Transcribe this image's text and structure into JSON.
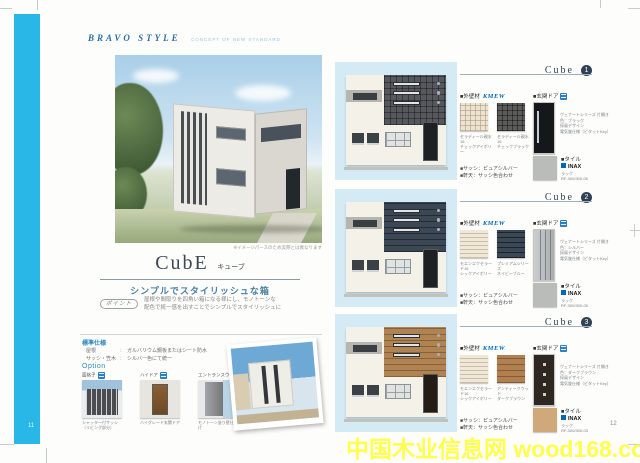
{
  "page": {
    "brand": "BRAVO STYLE",
    "brand_tagline": "CONCEPT OF NEW STANDARD",
    "page_number_left": "11",
    "page_number_right": "12",
    "watermark": "中国木业信息网 wood168.com"
  },
  "colors": {
    "accent_cyan": "#29b7e8",
    "brand_blue": "#2b6ea6",
    "subtitle_blue": "#4b7fa0",
    "panel_blue": "#d4eaf5",
    "kmew_blue": "#0068b7",
    "section_navy": "#2f4254",
    "watermark_yellow": "#ffff4d",
    "cube1_accent": "#55585c",
    "cube2_accent": "#3b4754",
    "cube3_accent": "#b08353"
  },
  "left_page": {
    "render_caption": "※イメージパースのため実際とは異なります",
    "title": "CubE",
    "title_kana": "キューブ",
    "subtitle": "シンプルでスタイリッシュな箱",
    "point": {
      "label": "ポイント",
      "line1": "屋根や間取りを四角い箱になる様にし、モノトーンな",
      "line2": "配色で統一感を出すことでシンプルでスタイリッシュに"
    },
    "spec": {
      "heading": "標準仕様",
      "rows": [
        {
          "label": "屋根",
          "value": "ガルバリウム鋼板またはシート防水"
        },
        {
          "label": "サッシ・笠木",
          "value": "シルバー色にて統一"
        }
      ]
    },
    "options": {
      "heading": "Option",
      "items": [
        {
          "label": "面格子",
          "caption": "シャッター付サッシ（リビング部分）"
        },
        {
          "label": "ハイドア",
          "caption": "ハイグレード玄関ドア"
        },
        {
          "label": "エントランスウォール",
          "caption": "モノトーン塗り壁仕上げ"
        }
      ]
    }
  },
  "sections": [
    {
      "title": "Cube",
      "number": "1",
      "wall_heading": "■外壁材",
      "wall_brand": "KMEW",
      "swatches": [
        {
          "caption1": "セラディール親水16",
          "caption2": "チェックアイボリー"
        },
        {
          "caption1": "セラディール親水16",
          "caption2": "チェックブラック"
        }
      ],
      "door_heading": "■玄関ドア",
      "door_caption": [
        "ヴェナートシリーズ 片開き",
        "色：ブラック",
        "採風デザイン",
        "電気錠仕様（ピタットKey）"
      ],
      "tile_heading": "■タイル",
      "tile_brand": "INAX",
      "tile_caption": [
        "ラック",
        "RF-300/300-05"
      ],
      "notes": [
        "■サッシ：ピュアシルバー",
        "■軒天：サッシ色合わせ"
      ]
    },
    {
      "title": "Cube",
      "number": "2",
      "wall_heading": "■外壁材",
      "wall_brand": "KMEW",
      "swatches": [
        {
          "caption1": "モエンエクセラード16",
          "caption2": "シックアイボリー"
        },
        {
          "caption1": "プレミアムシリーズ",
          "caption2": "ネイビーブルー"
        }
      ],
      "door_heading": "■玄関ドア",
      "door_caption": [
        "ヴェナートシリーズ 片開き",
        "色：シルバー",
        "採風デザイン",
        "電気錠仕様（ピタットKey）"
      ],
      "tile_heading": "■タイル",
      "tile_brand": "INAX",
      "tile_caption": [
        "ラック",
        "RF-300/300-05"
      ],
      "notes": [
        "■サッシ：ピュアシルバー",
        "■軒天：サッシ色合わせ"
      ]
    },
    {
      "title": "Cube",
      "number": "3",
      "wall_heading": "■外壁材",
      "wall_brand": "KMEW",
      "swatches": [
        {
          "caption1": "モエンエクセラード16",
          "caption2": "シックアイボリー"
        },
        {
          "caption1": "アンティークウッド",
          "caption2": "ダークブラウン"
        }
      ],
      "door_heading": "■玄関ドア",
      "door_caption": [
        "ヴェナートシリーズ 片開き",
        "色：ダークブラウン",
        "採風デザイン",
        "電気錠仕様（ピタットKey）"
      ],
      "tile_heading": "■タイル",
      "tile_brand": "INAX",
      "tile_caption": [
        "ラック",
        "RF-300/300-03"
      ],
      "notes": [
        "■サッシ：ピュアシルバー",
        "■軒天：サッシ色合わせ"
      ]
    }
  ]
}
